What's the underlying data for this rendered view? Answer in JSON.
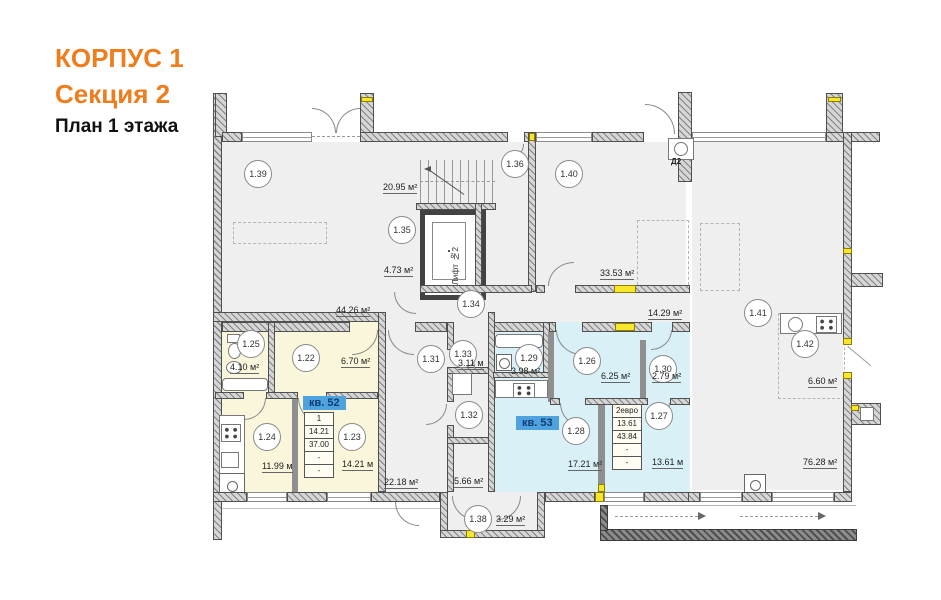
{
  "title": {
    "building": "КОРПУС 1",
    "section": "Секция 2",
    "floor": "План 1 этажа"
  },
  "colors": {
    "accent_orange": "#EE7D1E",
    "apt52_fill": "#FAF6DB",
    "apt53_fill": "#D8F0F6",
    "common_fill": "#EFEFEF",
    "highlight_blue": "#4EA2DE",
    "vent_yellow": "#F6E62C"
  },
  "rooms": {
    "r139": {
      "num": "1.39"
    },
    "r136": {
      "num": "1.36"
    },
    "r140": {
      "num": "1.40",
      "area": "33.53 м²"
    },
    "r135": {
      "num": "1.35",
      "area": "4.73 м²"
    },
    "r134": {
      "num": "1.34",
      "area": "44.26 м²"
    },
    "r141": {
      "num": "1.41",
      "area": "76.28 м²"
    },
    "r142": {
      "num": "1.42",
      "area": "6.60 м²"
    },
    "r125": {
      "num": "1.25",
      "area": "4.10 м²"
    },
    "r122": {
      "num": "1.22",
      "area": "6.70 м²"
    },
    "r124": {
      "num": "1.24",
      "area": "11.99 м"
    },
    "r123": {
      "num": "1.23",
      "area": "14.21 м"
    },
    "r131": {
      "num": "1.31"
    },
    "r132": {
      "num": "1.32"
    },
    "r133": {
      "num": "1.33",
      "area": "3.11 м"
    },
    "r129": {
      "num": "1.29",
      "area": "3.98 м²"
    },
    "r126": {
      "num": "1.26",
      "area": "6.25 м²"
    },
    "r130": {
      "num": "1.30",
      "area": "2.79 м²"
    },
    "r128": {
      "num": "1.28",
      "area": "17.21 м²"
    },
    "r127": {
      "num": "1.27",
      "area": "13.61 м"
    },
    "r138": {
      "num": "1.38",
      "area": "3.29 м²"
    },
    "stair": {
      "area": "20.95 м²"
    },
    "corr2": {
      "area": "14.29 м²"
    },
    "r2218": {
      "area": "22.18 м²"
    },
    "r566": {
      "area": "5.66 м²"
    }
  },
  "elevator": {
    "label": "Лифт №2"
  },
  "doors": {
    "d2": "Д2"
  },
  "apt52": {
    "label": "кв. 52",
    "specs": [
      "1",
      "14.21",
      "37.00",
      "-",
      "-"
    ]
  },
  "apt53": {
    "label": "кв. 53",
    "specs": [
      "2евро",
      "13.61",
      "43.84",
      "-",
      "-"
    ]
  }
}
